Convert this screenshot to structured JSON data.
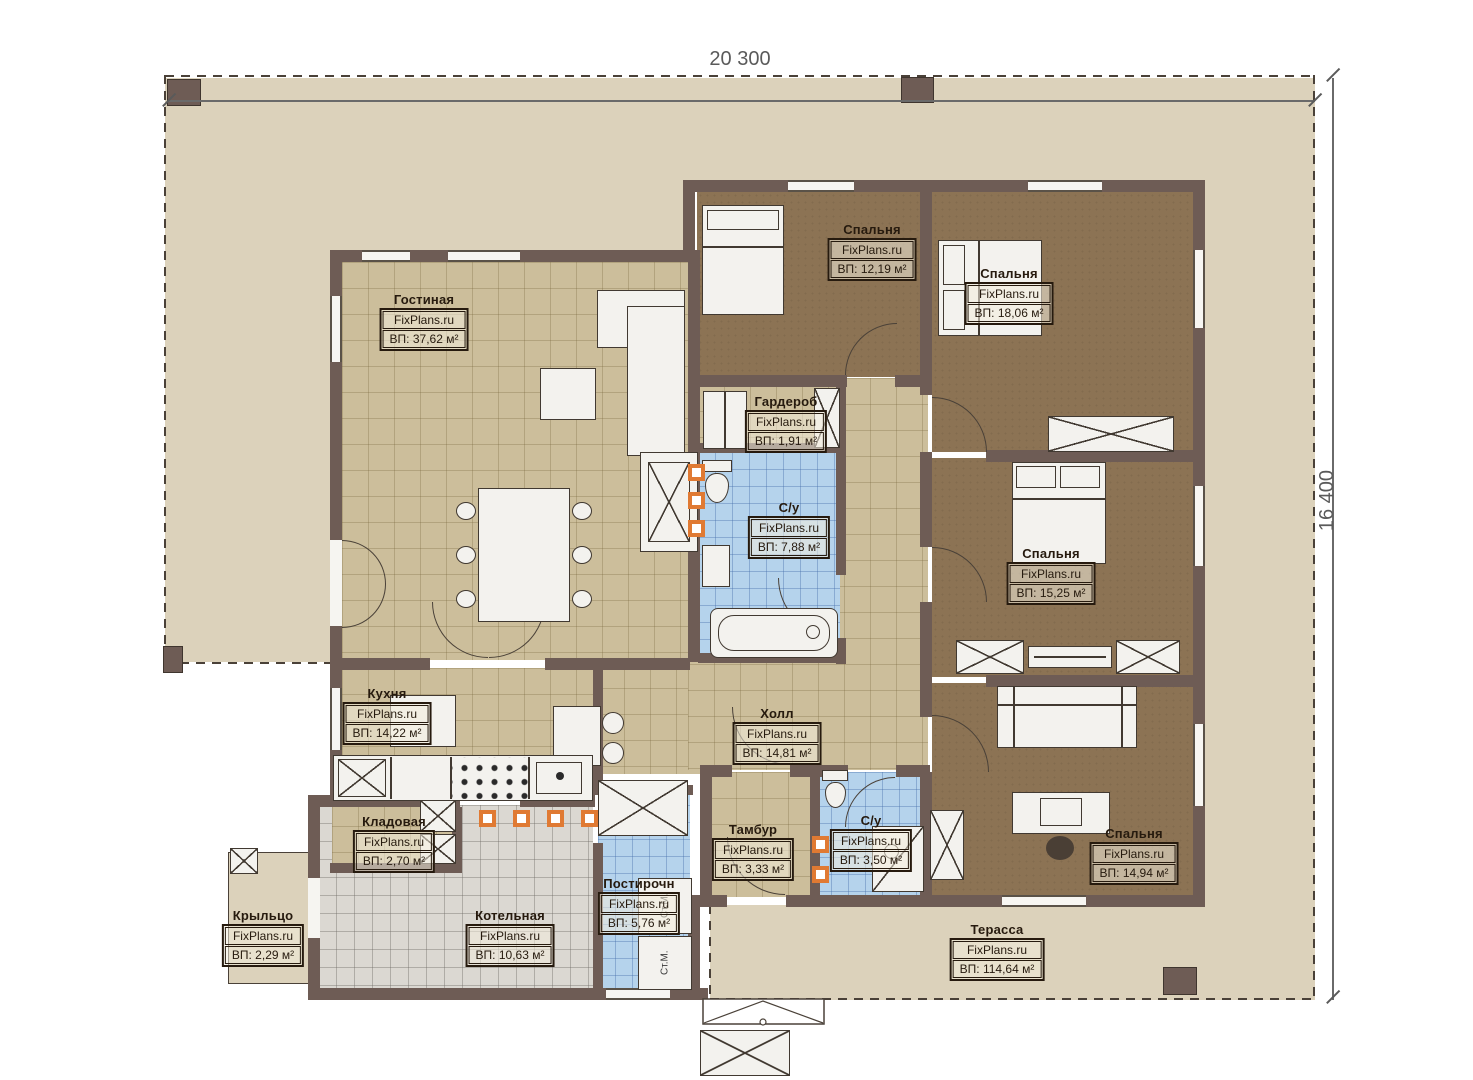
{
  "plan": {
    "dim_width": "20 300",
    "dim_height": "16 400",
    "watermark": "FixPlans.ru",
    "washer_label": "Ст.М.",
    "rooms": [
      {
        "id": "gostinaya",
        "name": "Гостиная",
        "area": "ВП: 37,62 м²"
      },
      {
        "id": "spalnya-1",
        "name": "Спальня",
        "area": "ВП: 12,19 м²"
      },
      {
        "id": "spalnya-2",
        "name": "Спальня",
        "area": "ВП: 18,06 м²"
      },
      {
        "id": "garderob",
        "name": "Гардероб",
        "area": "ВП: 1,91 м²"
      },
      {
        "id": "su-1",
        "name": "С/у",
        "area": "ВП: 7,88 м²"
      },
      {
        "id": "spalnya-3",
        "name": "Спальня",
        "area": "ВП: 15,25 м²"
      },
      {
        "id": "kuhnya",
        "name": "Кухня",
        "area": "ВП: 14,22 м²"
      },
      {
        "id": "holl",
        "name": "Холл",
        "area": "ВП: 14,81 м²"
      },
      {
        "id": "kladovaya",
        "name": "Кладовая",
        "area": "ВП: 2,70 м²"
      },
      {
        "id": "tambur",
        "name": "Тамбур",
        "area": "ВП: 3,33 м²"
      },
      {
        "id": "su-2",
        "name": "С/у",
        "area": "ВП: 3,50 м²"
      },
      {
        "id": "spalnya-4",
        "name": "Спальня",
        "area": "ВП: 14,94 м²"
      },
      {
        "id": "krylco",
        "name": "Крыльцо",
        "area": "ВП: 2,29 м²"
      },
      {
        "id": "kotelnaya",
        "name": "Котельная",
        "area": "ВП: 10,63 м²"
      },
      {
        "id": "postirochnaya",
        "name": "Постирочн",
        "area": "ВП: 5,76 м²"
      },
      {
        "id": "terassa",
        "name": "Терасса",
        "area": "ВП: 114,64 м²"
      }
    ],
    "colors": {
      "wall": "#6e5c55",
      "terrace": "#dcd2bb",
      "floor_tan": "#ccbe9b",
      "floor_brown": "#8c7354",
      "floor_blue": "#b5d3ec",
      "floor_gray": "#dbd8d2",
      "accent_orange": "#e07a33"
    }
  }
}
